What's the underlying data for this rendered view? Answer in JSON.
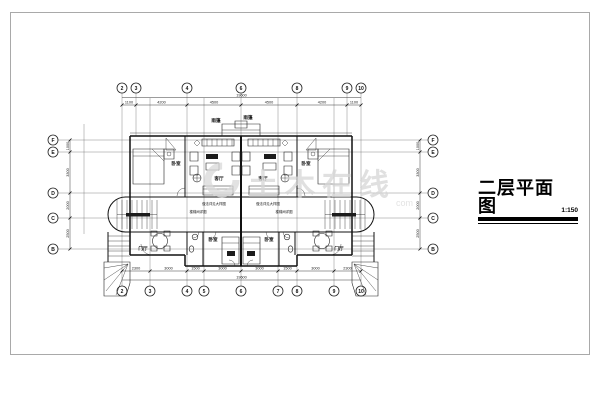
{
  "title": {
    "text": "二层平面图",
    "scale": "1:150"
  },
  "watermark": {
    "text": "土木在线",
    "suffix": "com"
  },
  "axes": {
    "top": [
      "2",
      "3",
      "4",
      "6",
      "8",
      "9",
      "10"
    ],
    "bottom": [
      "2",
      "3",
      "4",
      "5",
      "6",
      "7",
      "8",
      "9",
      "10"
    ],
    "left": [
      "F",
      "E",
      "D",
      "C",
      "B"
    ],
    "right": [
      "F",
      "E",
      "D",
      "C",
      "B"
    ]
  },
  "dims": {
    "top": [
      "1100",
      "4200",
      "4500",
      "4500",
      "4200",
      "1100"
    ],
    "top_total": "19600",
    "bottom": [
      "2300",
      "3000",
      "1500",
      "3000",
      "3000",
      "1500",
      "3000",
      "2300"
    ],
    "bottom_total": "19600",
    "left": [
      "1000",
      "3300",
      "2000",
      "2500"
    ],
    "right": [
      "1000",
      "3300",
      "2000",
      "2500"
    ]
  },
  "labels": {
    "bedroom": "卧室",
    "living": "客厅",
    "hall": "门厅",
    "canopy": "雨篷",
    "note_detail": "做法详见大样图",
    "note_stair": "楼梯间详图"
  }
}
